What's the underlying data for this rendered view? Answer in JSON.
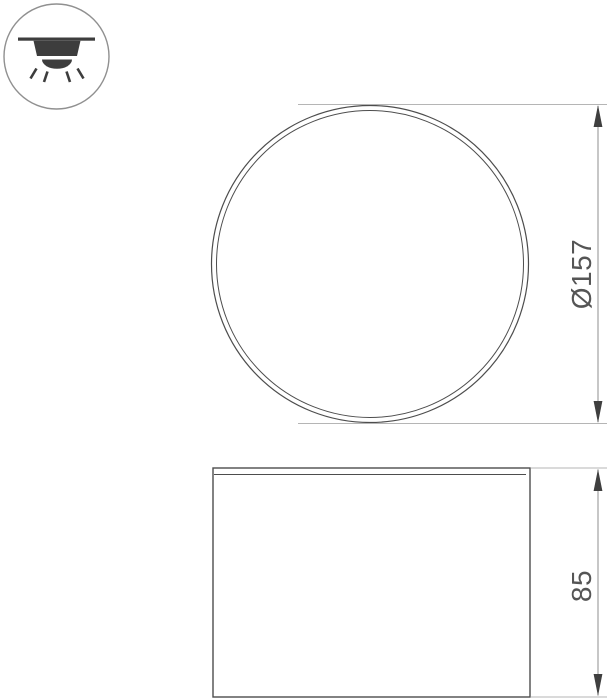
{
  "colors": {
    "background": "#ffffff",
    "drawing_line": "#4d4d4d",
    "extension_line": "#b5b5b5",
    "dimension_line": "#8f8f8f",
    "arrow": "#3f3f3f",
    "text": "#555555",
    "icon_outline": "#909090",
    "icon_fill": "#3d3d3d"
  },
  "icon": {
    "name": "surface-mounted-ceiling-downlight",
    "meaning": "ceiling surface mount luminaire, light emitted downward"
  },
  "top_view": {
    "name": "top view",
    "dimension": {
      "label": "Ø157",
      "type": "diameter",
      "value": 157
    }
  },
  "front_view": {
    "name": "front view",
    "dimension": {
      "label": "85",
      "type": "height",
      "value": 85
    }
  }
}
